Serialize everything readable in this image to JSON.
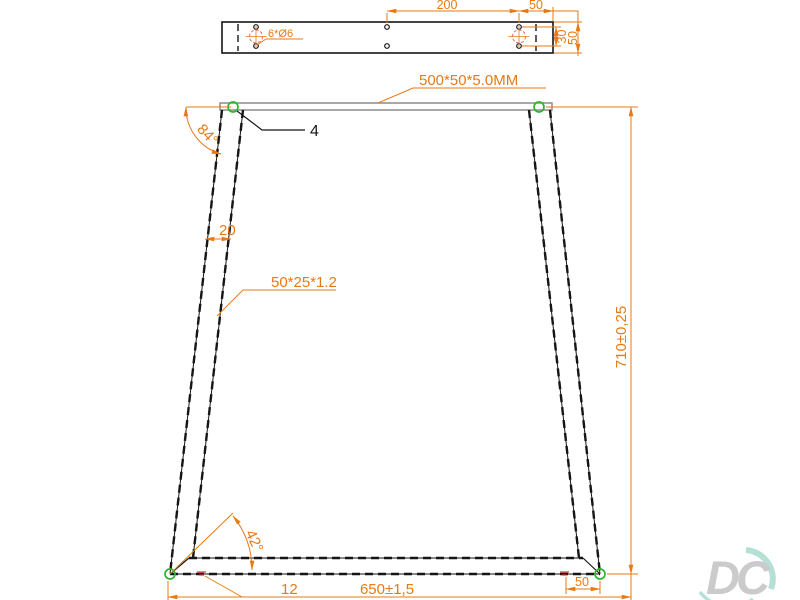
{
  "colors": {
    "dimension": "#e87a14",
    "line": "#161616",
    "plate_gray": "#8c8c8c",
    "weld_green": "#2db530",
    "center_mark_red": "#e86868",
    "tiny_mark_red": "#e03030",
    "watermark_gray": "#c3c3c3",
    "watermark_teal": "#a9dbd0"
  },
  "top_view": {
    "holes_label": "6*Ø6",
    "dim_hole_spacing": "200",
    "dim_end_offset": "50",
    "dim_hole_rows": "30",
    "dim_bar_height": "50"
  },
  "front_view": {
    "plate_spec": "500*50*5.0MM",
    "item_callout": "4",
    "angle_leg": "84°",
    "dim_leg_width": "20",
    "tube_spec": "50*25*1.2",
    "dim_height": "710±0,25",
    "angle_miter": "42°",
    "dim_offset": "12",
    "dim_base_width": "650±1,5",
    "dim_foot": "50"
  },
  "watermark": {
    "text": "DC"
  }
}
